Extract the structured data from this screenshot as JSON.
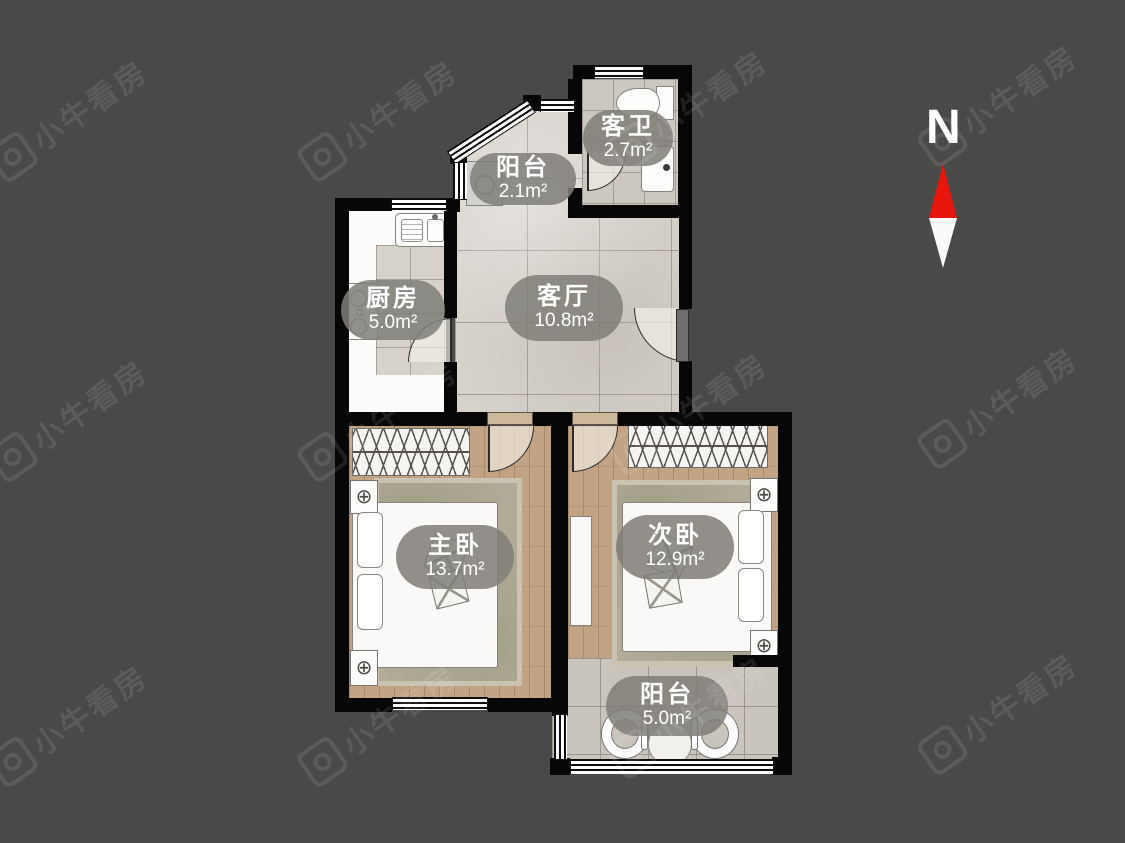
{
  "app": {
    "watermark_text": "小牛看房"
  },
  "compass": {
    "label": "N",
    "north_color": "#e8160c"
  },
  "rooms": [
    {
      "name": "客卫",
      "area": "2.7m²"
    },
    {
      "name": "阳台",
      "area": "2.1m²"
    },
    {
      "name": "厨房",
      "area": "5.0m²"
    },
    {
      "name": "客厅",
      "area": "10.8m²"
    },
    {
      "name": "主卧",
      "area": "13.7m²"
    },
    {
      "name": "次卧",
      "area": "12.9m²"
    },
    {
      "name": "阳台",
      "area": "5.0m²"
    }
  ],
  "colors": {
    "background": "#494948",
    "wall": "#070707",
    "tile_floor": "#d6d2cb",
    "wood_floor": "#c2a384",
    "label_badge": "rgba(128,126,120,0.86)",
    "compass_red": "#e8160c"
  }
}
